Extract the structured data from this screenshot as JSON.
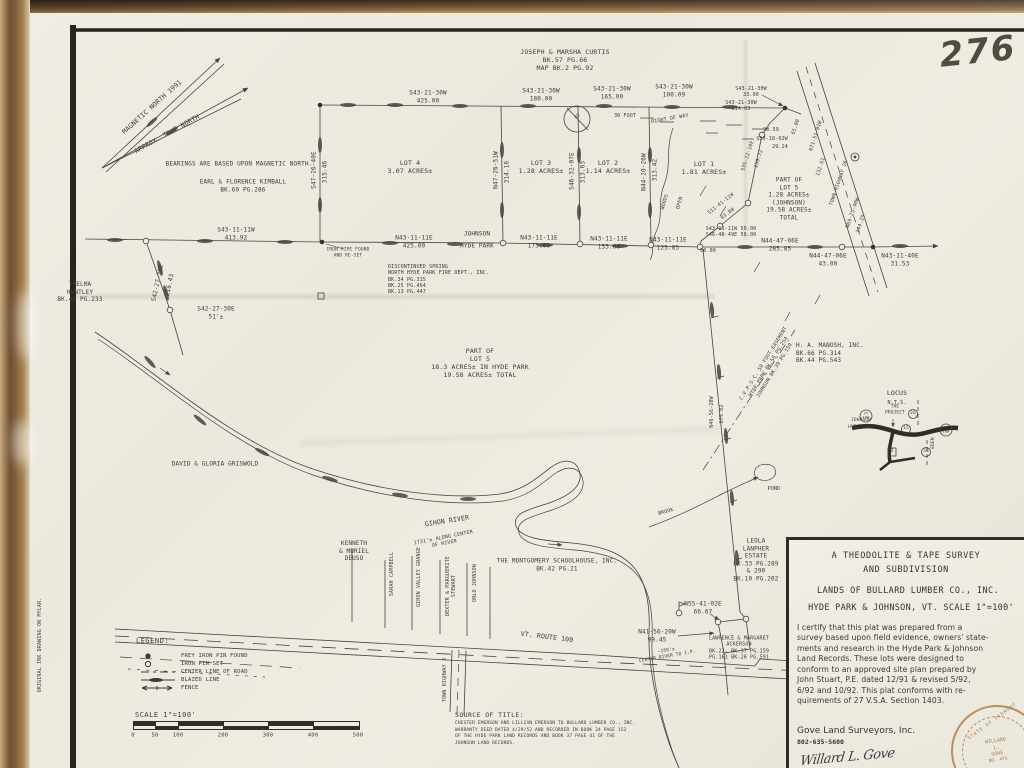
{
  "colors": {
    "paper": "#EDEAE0",
    "ink": "#3C3B34",
    "wood_frame": "#6E5132",
    "seal": "#BD8C5C"
  },
  "misc": {
    "sheet_number": "276",
    "margin_note": "ORIGINAL INK DRAWING ON MYLAR."
  },
  "north": {
    "magnetic": "MAGNETIC NORTH 1991",
    "true_north": "APPROX. TRUE NORTH",
    "note": "BEARINGS ARE BASED UPON MAGNETIC NORTH."
  },
  "owners": [
    "JOSEPH & MARSHA CURTIS\nBK.57 PG.66\nMAP BK.2 PG.92",
    "EARL & FLORENCE KIMBALL\nBK.60 PG.286",
    "THELMA\nHUNTLEY\nBK.46 PG.233",
    "DISCONTINUED SPRING\nNORTH HYDE PARK FIRE DEPT., INC.\nBK.34 PG.315\nBK.25 PG.464\nBK.13 PG.447",
    "DAVID & GLORIA GRISWOLD",
    "KENNETH\n& MURIEL\nDEUSO",
    "SARAH CAMPBELL",
    "GIHON VALLEY GRANGE",
    "DEXTER & MARGUERITE\nSTEWART",
    "ORLO JOHNSON",
    "THE MONTGOMERY SCHOOLHOUSE, INC.\nBK.42 PG.21",
    "H. A. MANOSH, INC.\nBK.66 PG.314\nBK.44 PG.543",
    "LEOLA\nLANPHER\nESTATE\nBK.33 PG.289\n& 290\nBK.10 PG.202",
    "LAWRENCE & MARGARET\nACKERSON\nBK.22,  BK.37 PG.159\nPG.161  BK.26 PG.591"
  ],
  "lots": [
    "LOT 4\n3.07 ACRES±",
    "LOT 3\n1.28 ACRES±",
    "LOT 2\n1.14 ACRES±",
    "LOT 1\n1.81 ACRES±",
    "PART OF\nLOT 5\n18.3 ACRES± IN HYDE PARK\n19.58 ACRES± TOTAL",
    "PART OF\nLOT 5\n1.28 ACRES±\n(JOHNSON)\n19.58 ACRES±\nTOTAL"
  ],
  "lines": [
    "S43-21-30W\n425.00",
    "S43-21-30W\n180.00",
    "S43-21-30W\n165.00",
    "S43-21-30W\n100.09",
    "30 FOOT",
    "RIGHT OF WAY",
    "S43-21-30W\n33.00",
    "S43-21-30W\n214.63",
    "S47-26-40E",
    "315.46",
    "N47-26-51W",
    "314.16",
    "S46-32-07E",
    "313.63",
    "N44-20-26W",
    "313.42",
    "WOODS",
    "OPEN",
    "S43-11-11W\n413.92",
    "N43-11-11E\n425.00",
    "JOHNSON",
    "HYDE PARK",
    "N43-11-11E\n175.00",
    "N43-11-11E\n153.00",
    "N43-11-11E\n125.85",
    "50.00",
    "IRON PIPE FOUND\nAND RE-SET",
    "S42-27-30E",
    "216.43",
    "S42-27-30E\n51'±",
    "30.59",
    "S50-18-02W",
    "29.24",
    "S35-22-10E",
    "159.72",
    "S11-41-11W",
    "83.00",
    "S43-11-11W 50.00\nS46-48-49E 50.00",
    "N44-47-06E\n285.85",
    "N44-47-06E\n43.00",
    "N43-11-40E\n31.53",
    "N71-51-01W",
    "65.00",
    "132.61",
    "TOWN HIGHWAY 26",
    "N69-25-40W",
    "144.25",
    "N46-56-20W",
    "875.02",
    "POND",
    "BROOK",
    "GIHON RIVER",
    "1731'± ALONG CENTER\nOF RIVER",
    "VT. ROUTE 100",
    "TOWN HIGHWAY 3",
    "N55-41-02E\n66.67",
    "N41-56-20W\n99.45",
    "~150'±\nCENTER RIVER TO I.P.",
    "C.V.P.S.C. 50 FOOT EASEMENT\nHYDE PARK  BK.56 PG.254\nJOHNSON  BK.39 PG.159",
    "45"
  ],
  "locus": {
    "title": "LOCUS",
    "nts": "N.T.S.",
    "project": "THE\nPROJECT",
    "johnson": "JOHNSON",
    "hyde_park": "HYDE PARK",
    "eden": "EDEN",
    "routes": [
      "VT\n100",
      "26",
      "15",
      "26",
      "3",
      "VT\n100"
    ]
  },
  "legend": {
    "title": "LEGEND:",
    "items": [
      {
        "label": "FREY IRON PIN FOUND"
      },
      {
        "label": "IRON PIN SET"
      },
      {
        "label": "CENTER LINE OF ROAD"
      },
      {
        "label": "BLAZED LINE"
      },
      {
        "label": "FENCE"
      }
    ],
    "scale_title": "SCALE 1\"=100'",
    "scale_ticks": [
      "0",
      "50",
      "100",
      "200",
      "300",
      "400",
      "500"
    ]
  },
  "source": {
    "title": "SOURCE OF TITLE:",
    "body": "CHESTER EMERSON AND LILLIAN EMERSON TO BULLARD LUMBER CO., INC.\nWARRANTY DEED DATED 4/29/52 AND RECORDED IN BOOK 34 PAGE 152\nOF THE HYDE PARK LAND RECORDS AND BOOK 37 PAGE 41 OF THE\nJOHNSON LAND RECORDS."
  },
  "titleblock": {
    "line1": "A THEODOLITE & TAPE SURVEY",
    "line2": "AND SUBDIVISION",
    "line3": "LANDS OF BULLARD LUMBER CO., INC.",
    "line4": "HYDE PARK & JOHNSON, VT. SCALE 1\"=100'",
    "certification": "I certify that this plat was prepared from a\nsurvey based upon field evidence, owners' state-\nments and research in the Hyde Park & Johnson\nLand Records.  These lots were designed to\nconform to an approved site plan prepared by\nJohn Stuart, P.E. dated 12/91 & revised 5/92,\n6/92 and 10/92.  This plat conforms with re-\nquirements of 27 V.S.A. Section 1403.",
    "firm": "Gove Land Surveyors, Inc.",
    "phone": "802-635-5600",
    "signature": "Willard L. Gove",
    "seal_state": "STATE OF VERMONT",
    "seal_name": "WILLARD\nL.\nGOVE",
    "seal_number": "NO. 475"
  }
}
